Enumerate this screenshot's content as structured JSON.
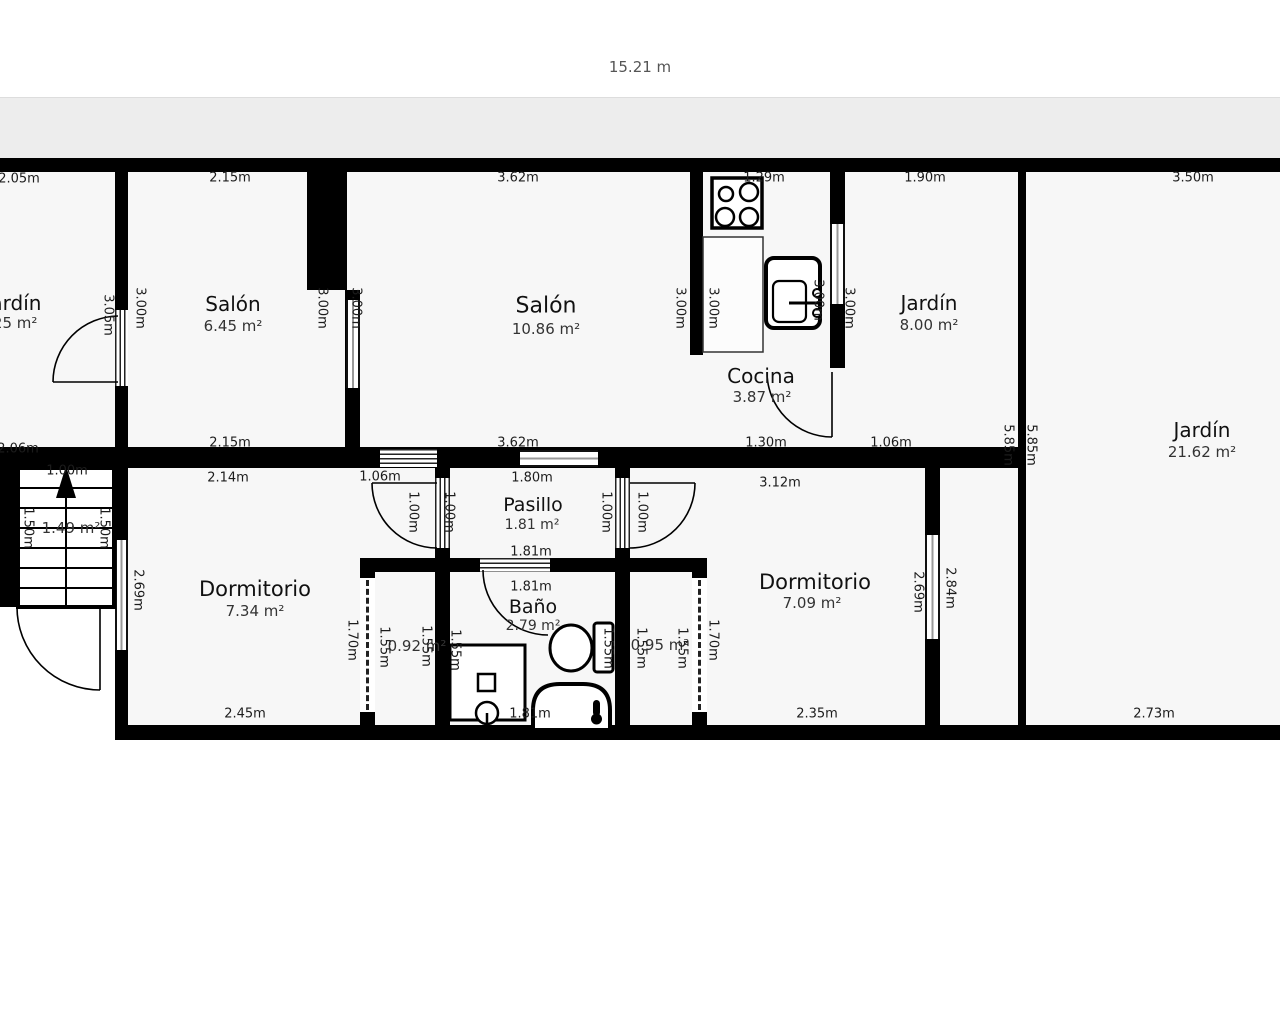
{
  "header": {
    "total_width_label": "15.21 m"
  },
  "rooms": {
    "jardin_left": {
      "name": "Jardín",
      "area": "6.25 m²"
    },
    "salon_small": {
      "name": "Salón",
      "area": "6.45 m²"
    },
    "salon_large": {
      "name": "Salón",
      "area": "10.86 m²"
    },
    "cocina": {
      "name": "Cocina",
      "area": "3.87 m²"
    },
    "jardin_mid": {
      "name": "Jardín",
      "area": "8.00 m²"
    },
    "jardin_large": {
      "name": "Jardín",
      "area": "21.62 m²"
    },
    "dormitorio_left": {
      "name": "Dormitorio",
      "area": "7.34 m²"
    },
    "pasillo": {
      "name": "Pasillo",
      "area": "1.81 m²"
    },
    "bano": {
      "name": "Baño",
      "area": "2.79 m²"
    },
    "dormitorio_right": {
      "name": "Dormitorio",
      "area": "7.09 m²"
    },
    "stairs": {
      "area": "1.49 m²"
    },
    "closet_left": {
      "area": "0.92 m²"
    },
    "closet_right": {
      "area": "0.95 m²"
    }
  },
  "dimensions": [
    {
      "text": "2.05m",
      "x": 19,
      "y": 179,
      "rot": 0
    },
    {
      "text": "2.15m",
      "x": 230,
      "y": 178,
      "rot": 0
    },
    {
      "text": "3.62m",
      "x": 518,
      "y": 178,
      "rot": 0
    },
    {
      "text": "1.29m",
      "x": 764,
      "y": 178,
      "rot": 0
    },
    {
      "text": "1.90m",
      "x": 925,
      "y": 178,
      "rot": 0
    },
    {
      "text": "3.50m",
      "x": 1193,
      "y": 178,
      "rot": 0
    },
    {
      "text": "3.05m",
      "x": 108,
      "y": 315,
      "rot": 90
    },
    {
      "text": "3.00m",
      "x": 140,
      "y": 308,
      "rot": 90
    },
    {
      "text": "3.00m",
      "x": 322,
      "y": 308,
      "rot": 90
    },
    {
      "text": "3.00m",
      "x": 356,
      "y": 308,
      "rot": 90
    },
    {
      "text": "3.00m",
      "x": 680,
      "y": 308,
      "rot": 90
    },
    {
      "text": "3.00m",
      "x": 713,
      "y": 308,
      "rot": 90
    },
    {
      "text": "3.00m",
      "x": 818,
      "y": 300,
      "rot": 90
    },
    {
      "text": "3.00m",
      "x": 849,
      "y": 308,
      "rot": 90
    },
    {
      "text": "2.06m",
      "x": 18,
      "y": 449,
      "rot": 0
    },
    {
      "text": "2.15m",
      "x": 230,
      "y": 443,
      "rot": 0
    },
    {
      "text": "3.62m",
      "x": 518,
      "y": 443,
      "rot": 0
    },
    {
      "text": "1.30m",
      "x": 766,
      "y": 443,
      "rot": 0
    },
    {
      "text": "1.06m",
      "x": 891,
      "y": 443,
      "rot": 0
    },
    {
      "text": "5.85m",
      "x": 1008,
      "y": 445,
      "rot": 90
    },
    {
      "text": "5.85m",
      "x": 1031,
      "y": 445,
      "rot": 90
    },
    {
      "text": "1.00m",
      "x": 67,
      "y": 471,
      "rot": 0
    },
    {
      "text": "2.14m",
      "x": 228,
      "y": 478,
      "rot": 0
    },
    {
      "text": "1.06m",
      "x": 380,
      "y": 477,
      "rot": 0
    },
    {
      "text": "1.80m",
      "x": 532,
      "y": 478,
      "rot": 0
    },
    {
      "text": "3.12m",
      "x": 780,
      "y": 483,
      "rot": 0
    },
    {
      "text": "1.00m",
      "x": 413,
      "y": 512,
      "rot": 90
    },
    {
      "text": "1.00m",
      "x": 449,
      "y": 512,
      "rot": 90
    },
    {
      "text": "1.00m",
      "x": 606,
      "y": 512,
      "rot": 90
    },
    {
      "text": "1.00m",
      "x": 642,
      "y": 512,
      "rot": 90
    },
    {
      "text": "1.50m",
      "x": 28,
      "y": 528,
      "rot": 90
    },
    {
      "text": "1.50m",
      "x": 104,
      "y": 528,
      "rot": 90
    },
    {
      "text": "1.81m",
      "x": 531,
      "y": 552,
      "rot": 0
    },
    {
      "text": "1.81m",
      "x": 531,
      "y": 587,
      "rot": 0
    },
    {
      "text": "2.69m",
      "x": 138,
      "y": 590,
      "rot": 90
    },
    {
      "text": "2.69m",
      "x": 918,
      "y": 592,
      "rot": 90
    },
    {
      "text": "2.84m",
      "x": 950,
      "y": 588,
      "rot": 90
    },
    {
      "text": "1.70m",
      "x": 352,
      "y": 640,
      "rot": 90
    },
    {
      "text": "1.70m",
      "x": 713,
      "y": 640,
      "rot": 90
    },
    {
      "text": "1.55m",
      "x": 384,
      "y": 647,
      "rot": 90
    },
    {
      "text": "1.55m",
      "x": 426,
      "y": 646,
      "rot": 90
    },
    {
      "text": "1.55m",
      "x": 455,
      "y": 650,
      "rot": 90
    },
    {
      "text": "1.55m",
      "x": 608,
      "y": 648,
      "rot": 90
    },
    {
      "text": "1.55m",
      "x": 641,
      "y": 648,
      "rot": 90
    },
    {
      "text": "1.55m",
      "x": 682,
      "y": 648,
      "rot": 90
    },
    {
      "text": "2.45m",
      "x": 245,
      "y": 714,
      "rot": 0
    },
    {
      "text": "1.81m",
      "x": 530,
      "y": 714,
      "rot": 0
    },
    {
      "text": "2.35m",
      "x": 817,
      "y": 714,
      "rot": 0
    },
    {
      "text": "2.73m",
      "x": 1154,
      "y": 714,
      "rot": 0
    }
  ]
}
